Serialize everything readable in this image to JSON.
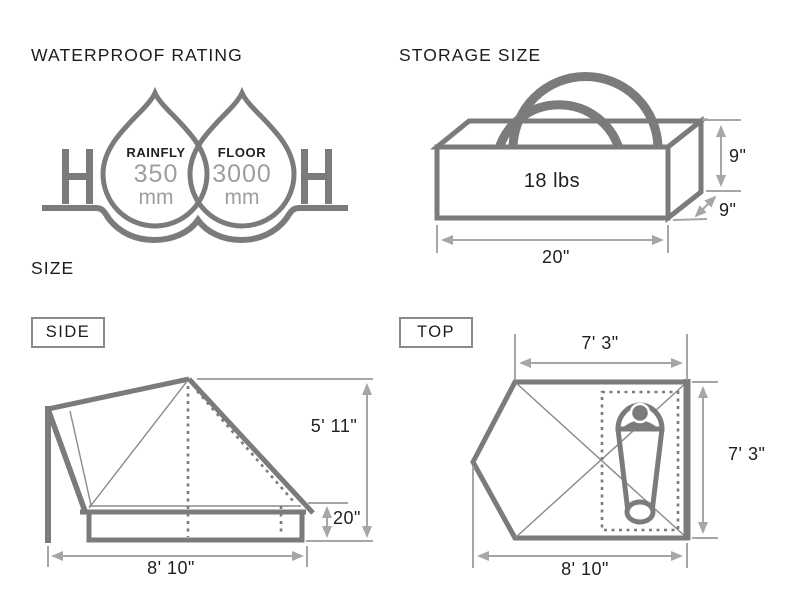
{
  "waterproof": {
    "title": "WATERPROOF RATING",
    "drops": [
      {
        "label": "RAINFLY",
        "value": "350",
        "unit": "mm"
      },
      {
        "label": "FLOOR",
        "value": "3000",
        "unit": "mm"
      }
    ]
  },
  "storage": {
    "title": "STORAGE SIZE",
    "weight": "18 lbs",
    "dims": {
      "height": "9\"",
      "depth": "9\"",
      "width": "20\""
    }
  },
  "size": {
    "title": "SIZE",
    "side": {
      "label": "SIDE",
      "peak_height": "5' 11\"",
      "base_height": "20\"",
      "width": "8' 10\""
    },
    "top": {
      "label": "TOP",
      "inner_width": "7' 3\"",
      "depth": "7' 3\"",
      "width": "8' 10\""
    }
  },
  "colors": {
    "outline": "#7b7b7b",
    "thin_line": "#8a8a8a",
    "dimension_line": "#a6a6a6",
    "text": "#1c1c1c",
    "muted_value": "#9e9e9e"
  }
}
